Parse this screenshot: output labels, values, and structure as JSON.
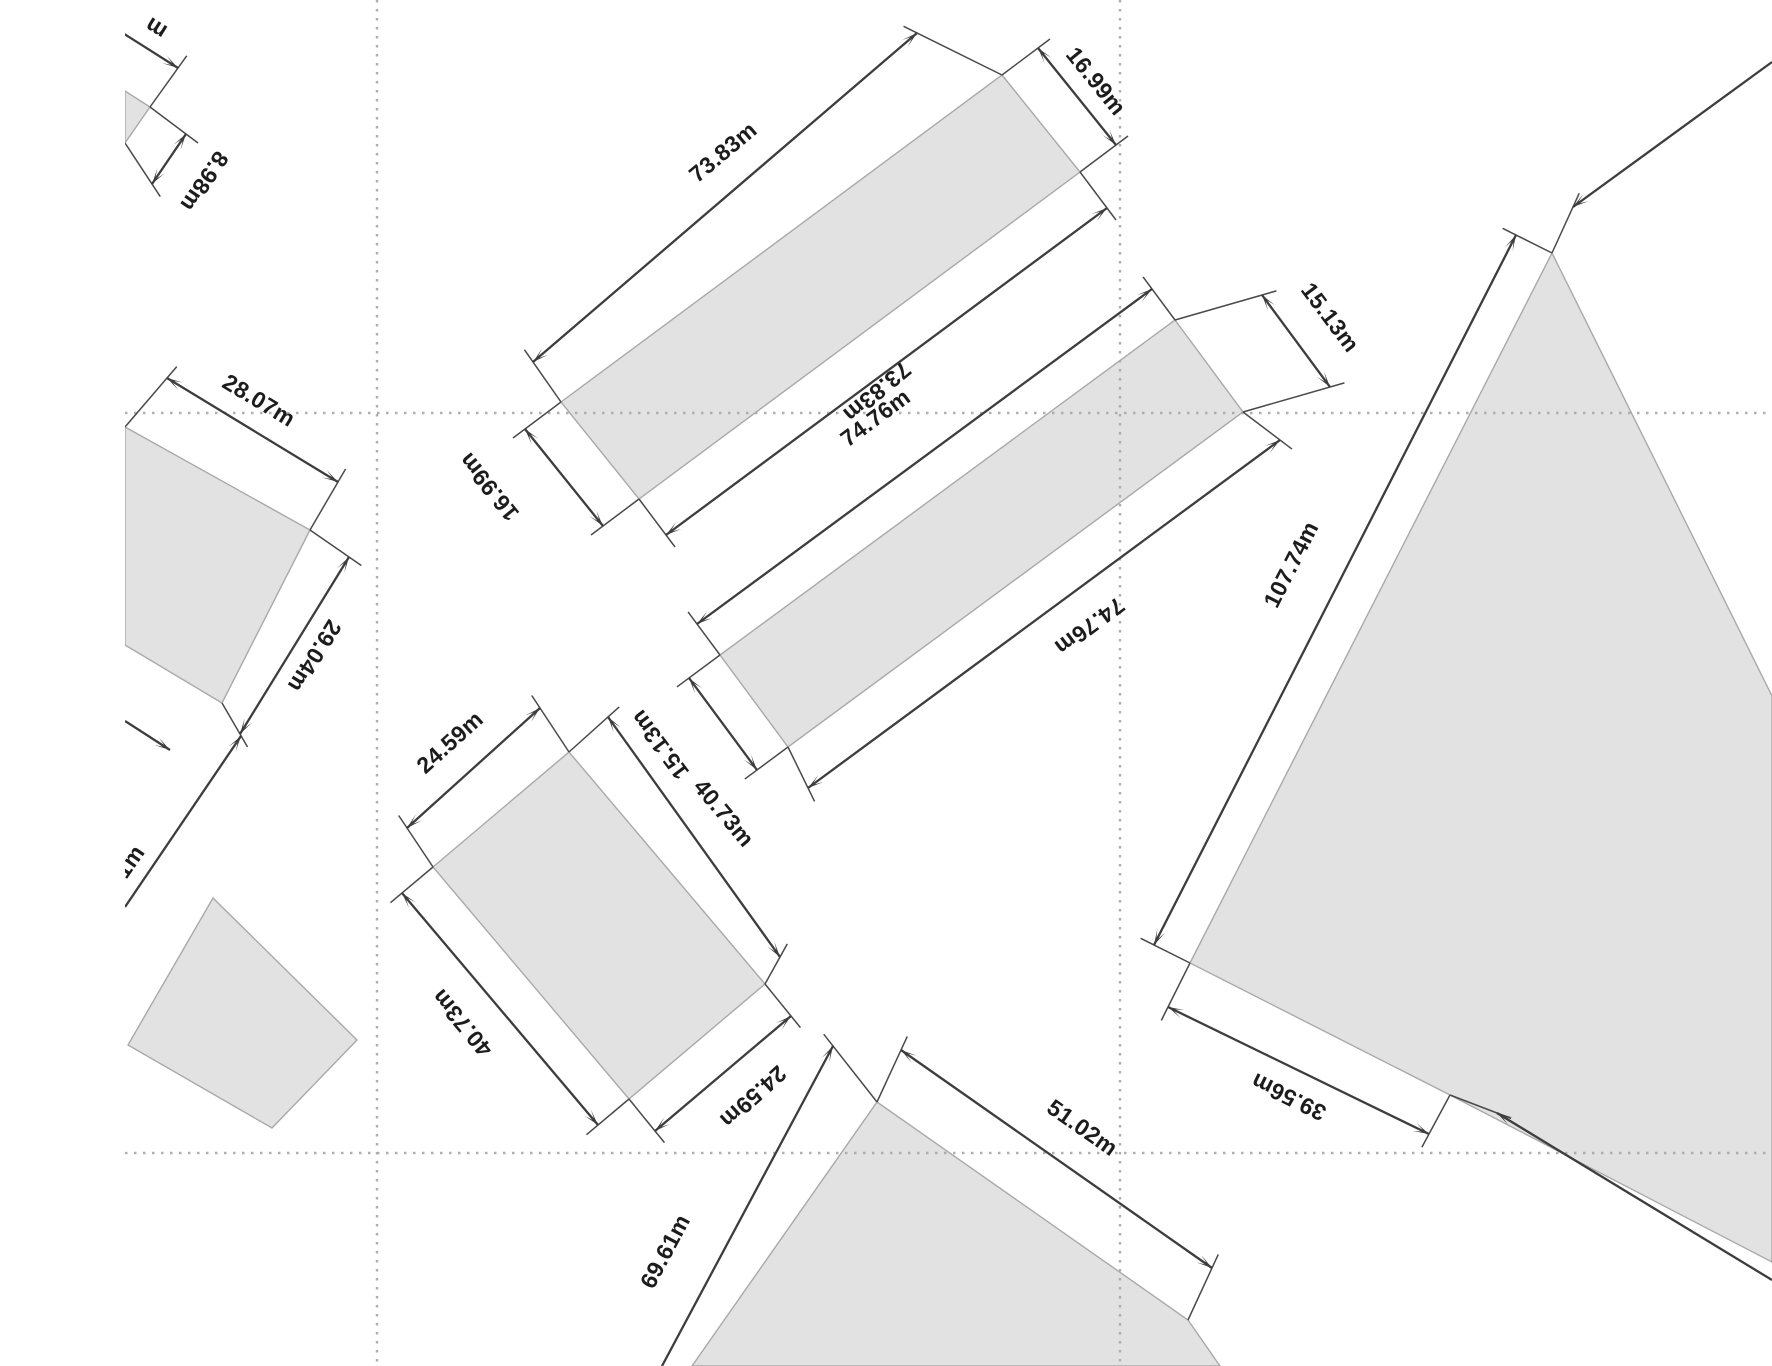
{
  "canvas": {
    "width": 1772,
    "height": 1366,
    "background": "#ffffff",
    "clip_left": 125
  },
  "style": {
    "parcel_fill": "#e2e2e2",
    "parcel_stroke": "#a9a9a9",
    "dim_color": "#3d3d3d",
    "ext_color": "#4a4a4a",
    "grid_color": "#ababab",
    "label_color": "#1c1c1c",
    "label_font_size": 23,
    "grid_dash": "2.5 6.5",
    "dim_width": 2.3,
    "ext_width": 1.5,
    "grid_width": 2.4
  },
  "gridlines": [
    {
      "id": "grid-vertical-1",
      "x1": 377,
      "y1": 0,
      "x2": 377,
      "y2": 1366
    },
    {
      "id": "grid-vertical-2",
      "x1": 1120,
      "y1": 0,
      "x2": 1120,
      "y2": 1366
    },
    {
      "id": "grid-horizontal-1",
      "x1": 125,
      "y1": 413,
      "x2": 1772,
      "y2": 413
    },
    {
      "id": "grid-horizontal-2",
      "x1": 125,
      "y1": 1153,
      "x2": 1772,
      "y2": 1153
    }
  ],
  "parcels": [
    {
      "id": "parcel-topleft-clipped",
      "points": [
        [
          125,
          91
        ],
        [
          150,
          107
        ],
        [
          125,
          143
        ]
      ]
    },
    {
      "id": "parcel-west",
      "points": [
        [
          125,
          427
        ],
        [
          310,
          530
        ],
        [
          222,
          703
        ],
        [
          125,
          645
        ]
      ]
    },
    {
      "id": "parcel-long-north",
      "points": [
        [
          561,
          402
        ],
        [
          1002,
          75
        ],
        [
          1080,
          172
        ],
        [
          639,
          499
        ]
      ]
    },
    {
      "id": "parcel-long-middle",
      "points": [
        [
          720,
          655
        ],
        [
          1175,
          320
        ],
        [
          1243,
          412
        ],
        [
          788,
          747
        ]
      ]
    },
    {
      "id": "parcel-center",
      "points": [
        [
          433,
          867
        ],
        [
          569,
          752
        ],
        [
          765,
          984
        ],
        [
          629,
          1099
        ]
      ]
    },
    {
      "id": "parcel-south",
      "points": [
        [
          877,
          1102
        ],
        [
          1188,
          1320
        ],
        [
          1220,
          1366
        ],
        [
          692,
          1366
        ]
      ]
    },
    {
      "id": "parcel-east-large",
      "points": [
        [
          1552,
          253
        ],
        [
          1190,
          963
        ],
        [
          1450,
          1095
        ],
        [
          1772,
          1262
        ],
        [
          1772,
          696
        ]
      ]
    },
    {
      "id": "parcel-southwest",
      "points": [
        [
          213,
          898
        ],
        [
          357,
          1040
        ],
        [
          272,
          1128
        ],
        [
          128,
          1045
        ]
      ]
    }
  ],
  "dimensions": [
    {
      "id": "dim-topleft-length-clipped",
      "x1": 118,
      "y1": 30,
      "x2": 178,
      "y2": 68,
      "arrow_start": false,
      "arrow_end": true,
      "ext2": [
        150,
        107
      ],
      "label": "m",
      "lx": 160,
      "ly": 22,
      "rot": 212
    },
    {
      "id": "dim-topleft-width",
      "x1": 186,
      "y1": 134,
      "x2": 152,
      "y2": 184,
      "arrow_start": true,
      "arrow_end": true,
      "ext1": [
        150,
        107
      ],
      "ext2": [
        125,
        143
      ],
      "label": "8.98m",
      "lx": 198,
      "ly": 177,
      "rot": 124
    },
    {
      "id": "dim-west-top",
      "x1": 167,
      "y1": 378,
      "x2": 338,
      "y2": 482,
      "arrow_start": true,
      "arrow_end": true,
      "ext1": [
        125,
        427
      ],
      "ext2": [
        310,
        530
      ],
      "label": "28.07m",
      "lx": 255,
      "ly": 407,
      "rot": 31
    },
    {
      "id": "dim-west-right",
      "x1": 349,
      "y1": 557,
      "x2": 240,
      "y2": 734,
      "arrow_start": true,
      "arrow_end": true,
      "ext1": [
        310,
        530
      ],
      "ext2": [
        222,
        703
      ],
      "label": "29.04m",
      "lx": 308,
      "ly": 652,
      "rot": 122
    },
    {
      "id": "dim-west-bottom-clipped",
      "x1": 125,
      "y1": 721,
      "x2": 170,
      "y2": 750,
      "arrow_start": false,
      "arrow_end": true
    },
    {
      "id": "dim-southwest-left-clipped",
      "x1": 125,
      "y1": 907,
      "x2": 241,
      "y2": 736,
      "arrow_start": false,
      "arrow_end": true,
      "label": "1m",
      "lx": 136,
      "ly": 866,
      "rot": -55
    },
    {
      "id": "dim-north-top",
      "x1": 533,
      "y1": 362,
      "x2": 917,
      "y2": 33,
      "arrow_start": true,
      "arrow_end": true,
      "ext1": [
        561,
        402
      ],
      "ext2": [
        1002,
        75
      ],
      "label": "73.83m",
      "lx": 728,
      "ly": 158,
      "rot": -40
    },
    {
      "id": "dim-north-bottom",
      "x1": 666,
      "y1": 535,
      "x2": 1107,
      "y2": 208,
      "arrow_start": true,
      "arrow_end": true,
      "ext1": [
        639,
        499
      ],
      "ext2": [
        1080,
        172
      ],
      "label": "73.83m",
      "lx": 872,
      "ly": 386,
      "rot": 140
    },
    {
      "id": "dim-north-west-end",
      "x1": 525,
      "y1": 429,
      "x2": 603,
      "y2": 526,
      "arrow_start": true,
      "arrow_end": true,
      "ext1": [
        561,
        402
      ],
      "ext2": [
        639,
        499
      ],
      "label": "16.99m",
      "lx": 495,
      "ly": 482,
      "rot": 231
    },
    {
      "id": "dim-north-east-end",
      "x1": 1038,
      "y1": 48,
      "x2": 1116,
      "y2": 145,
      "arrow_start": true,
      "arrow_end": true,
      "ext1": [
        1002,
        75
      ],
      "ext2": [
        1080,
        172
      ],
      "label": "16.99m",
      "lx": 1090,
      "ly": 86,
      "rot": 51
    },
    {
      "id": "dim-middle-top",
      "x1": 697,
      "y1": 624,
      "x2": 1152,
      "y2": 289,
      "arrow_start": true,
      "arrow_end": true,
      "ext1": [
        720,
        655
      ],
      "ext2": [
        1175,
        320
      ],
      "label": "74.76m",
      "lx": 880,
      "ly": 424,
      "rot": -36.5
    },
    {
      "id": "dim-middle-bottom",
      "x1": 808,
      "y1": 788,
      "x2": 1280,
      "y2": 440,
      "arrow_start": true,
      "arrow_end": true,
      "ext1": [
        788,
        747
      ],
      "ext2": [
        1243,
        412
      ],
      "label": "74.76m",
      "lx": 1085,
      "ly": 620,
      "rot": 143.5
    },
    {
      "id": "dim-middle-west-end",
      "x1": 689,
      "y1": 678,
      "x2": 757,
      "y2": 770,
      "arrow_start": true,
      "arrow_end": true,
      "ext1": [
        720,
        655
      ],
      "ext2": [
        788,
        747
      ],
      "label": "15.13m",
      "lx": 666,
      "ly": 740,
      "rot": 233
    },
    {
      "id": "dim-middle-east-end",
      "x1": 1262,
      "y1": 295,
      "x2": 1330,
      "y2": 387,
      "arrow_start": true,
      "arrow_end": true,
      "ext1": [
        1175,
        320
      ],
      "ext2": [
        1243,
        412
      ],
      "label": "15.13m",
      "lx": 1324,
      "ly": 322,
      "rot": 53
    },
    {
      "id": "dim-center-top",
      "x1": 407,
      "y1": 828,
      "x2": 540,
      "y2": 708,
      "arrow_start": true,
      "arrow_end": true,
      "ext1": [
        433,
        867
      ],
      "ext2": [
        569,
        752
      ],
      "label": "24.59m",
      "lx": 455,
      "ly": 748,
      "rot": -42
    },
    {
      "id": "dim-center-right",
      "x1": 608,
      "y1": 717,
      "x2": 780,
      "y2": 957,
      "arrow_start": true,
      "arrow_end": true,
      "ext1": [
        569,
        752
      ],
      "ext2": [
        765,
        984
      ],
      "label": "40.73m",
      "lx": 718,
      "ly": 818,
      "rot": 50
    },
    {
      "id": "dim-center-left",
      "x1": 402,
      "y1": 893,
      "x2": 598,
      "y2": 1125,
      "arrow_start": true,
      "arrow_end": true,
      "ext1": [
        433,
        867
      ],
      "ext2": [
        629,
        1099
      ],
      "label": "40.73m",
      "lx": 468,
      "ly": 1018,
      "rot": 230
    },
    {
      "id": "dim-center-bottom",
      "x1": 655,
      "y1": 1131,
      "x2": 791,
      "y2": 1016,
      "arrow_start": true,
      "arrow_end": true,
      "ext1": [
        629,
        1099
      ],
      "ext2": [
        765,
        984
      ],
      "label": "24.59m",
      "lx": 748,
      "ly": 1091,
      "rot": 138
    },
    {
      "id": "dim-south-top",
      "x1": 901,
      "y1": 1050,
      "x2": 1212,
      "y2": 1268,
      "arrow_start": true,
      "arrow_end": true,
      "ext1": [
        877,
        1102
      ],
      "ext2": [
        1188,
        1320
      ],
      "label": "51.02m",
      "lx": 1078,
      "ly": 1134,
      "rot": 35
    },
    {
      "id": "dim-south-left",
      "x1": 833,
      "y1": 1046,
      "x2": 662,
      "y2": 1366,
      "arrow_start": true,
      "arrow_end": false,
      "ext1": [
        877,
        1102
      ],
      "label": "69.61m",
      "lx": 672,
      "ly": 1255,
      "rot": -62
    },
    {
      "id": "dim-east-long",
      "x1": 1154,
      "y1": 945,
      "x2": 1516,
      "y2": 235,
      "arrow_start": true,
      "arrow_end": true,
      "ext1": [
        1190,
        963
      ],
      "ext2": [
        1552,
        253
      ],
      "label": "107.74m",
      "lx": 1298,
      "ly": 568,
      "rot": -63
    },
    {
      "id": "dim-east-bottom",
      "x1": 1168,
      "y1": 1007,
      "x2": 1429,
      "y2": 1134,
      "arrow_start": true,
      "arrow_end": true,
      "ext1": [
        1190,
        963
      ],
      "ext2": [
        1450,
        1095
      ],
      "label": "39.56m",
      "lx": 1292,
      "ly": 1090,
      "rot": 206
    },
    {
      "id": "dim-east-top-clipped",
      "x1": 1573,
      "y1": 207,
      "x2": 1772,
      "y2": 62,
      "arrow_start": true,
      "arrow_end": false,
      "ext1": [
        1552,
        253
      ]
    },
    {
      "id": "dim-east-right-clipped",
      "x1": 1497,
      "y1": 1113,
      "x2": 1772,
      "y2": 1280,
      "arrow_start": true,
      "arrow_end": false,
      "ext1": [
        1450,
        1095
      ]
    }
  ]
}
